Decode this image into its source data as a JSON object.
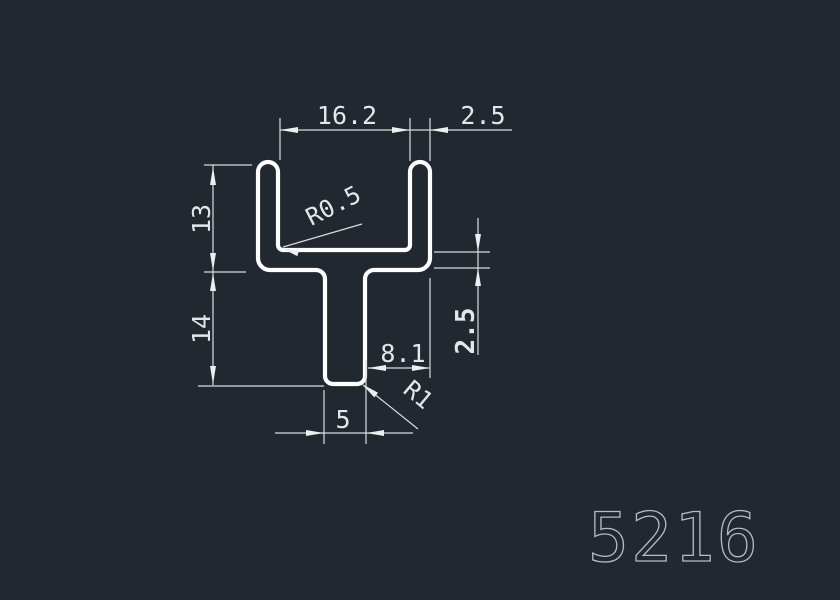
{
  "canvas": {
    "background_color": "#212830",
    "profile_line_color": "#ffffff",
    "dimension_line_color": "#d8dcdf",
    "arrow_color": "#eceef0",
    "text_color": "#e4e7ea",
    "part_number_color": "#b6bcc4"
  },
  "labels": {
    "dim_inner_width": "16.2",
    "dim_wall_thickness": "2.5",
    "dim_channel_depth": "13",
    "dim_stem_height": "14",
    "dim_web_thickness": "2.5",
    "dim_stem_to_edge": "8.1",
    "dim_stem_width": "5",
    "dim_inner_fillet": "R0.5",
    "dim_bottom_fillet": "R1",
    "part_number": "5216"
  }
}
